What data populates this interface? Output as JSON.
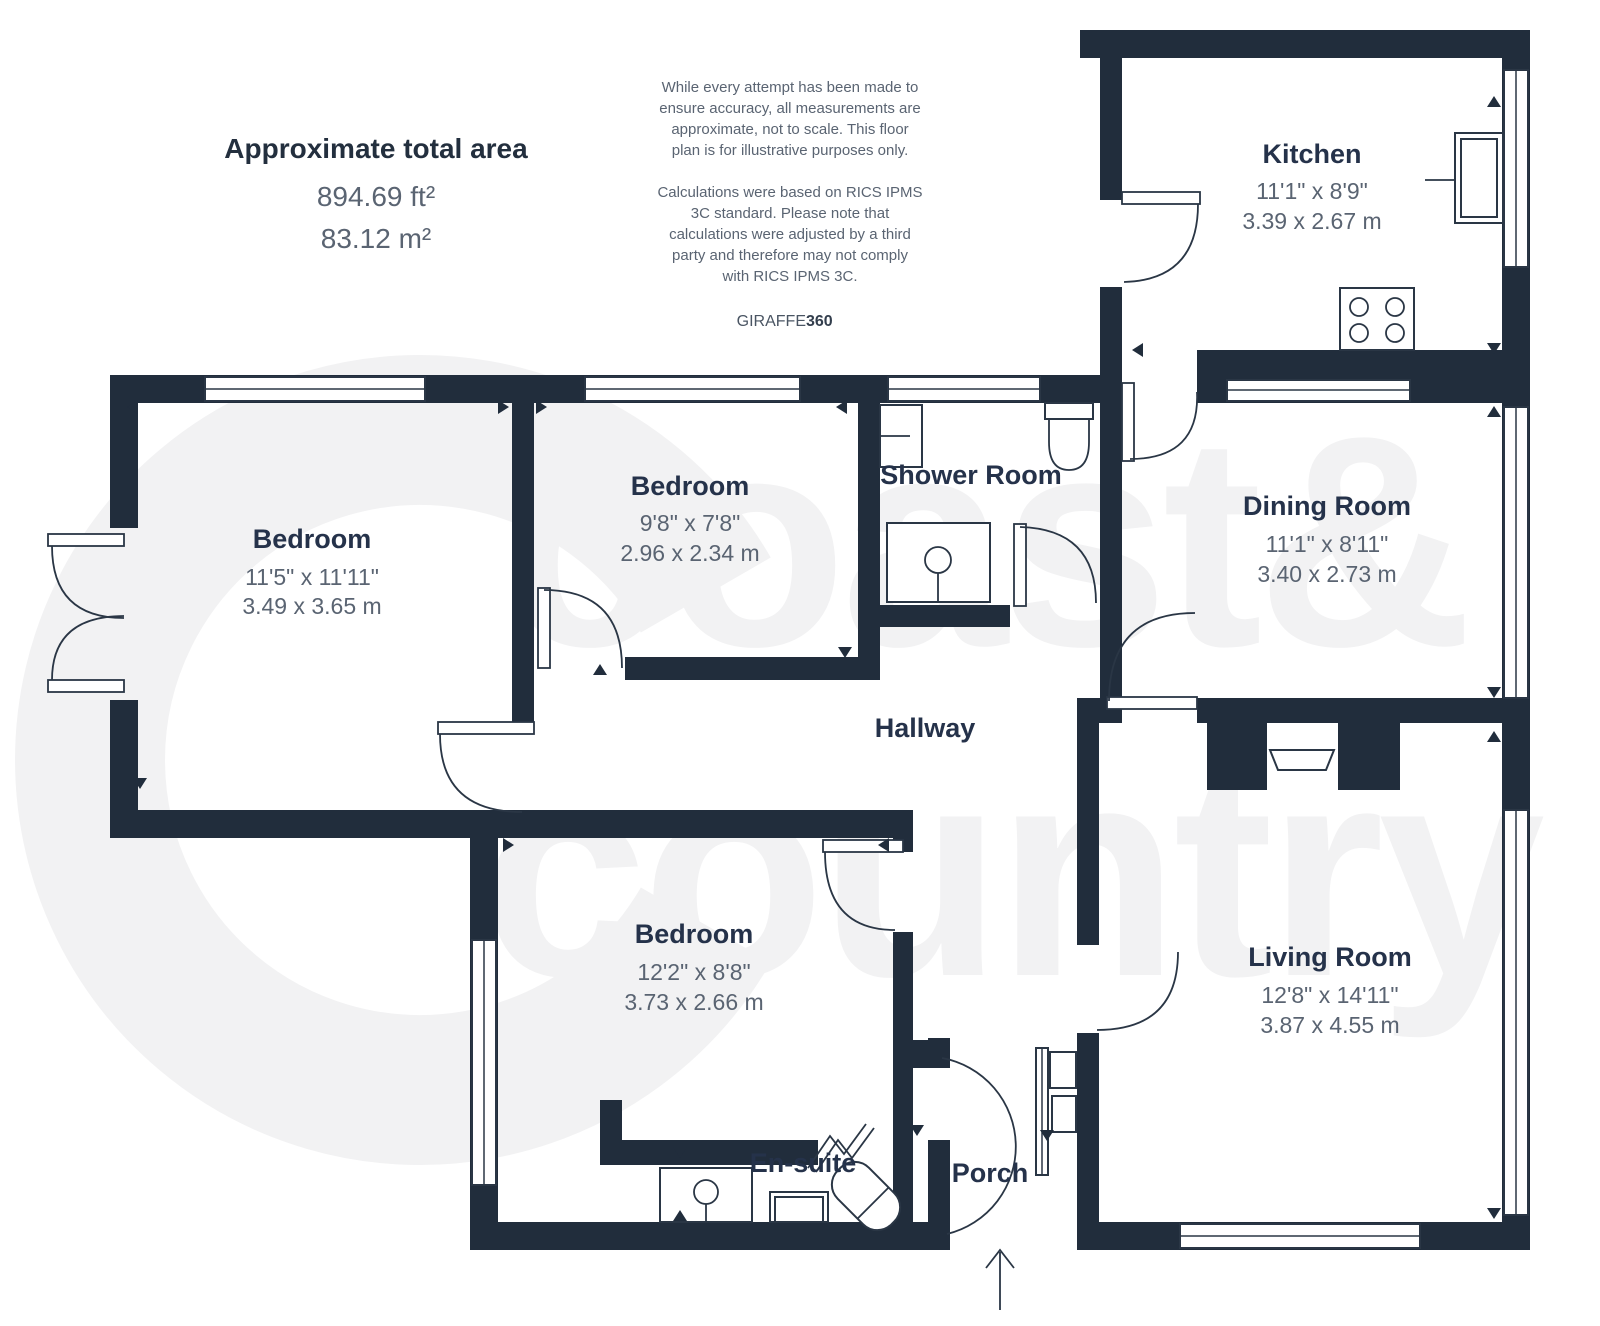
{
  "summary": {
    "title": "Approximate total area",
    "area_imperial": "894.69 ft²",
    "area_metric": "83.12 m²"
  },
  "disclaimer": {
    "para1": [
      "While every attempt has been made to",
      "ensure accuracy, all measurements are",
      "approximate, not to scale. This floor",
      "plan is for illustrative purposes only."
    ],
    "para2": [
      "Calculations were based on RICS IPMS",
      "3C standard. Please note that",
      "calculations were adjusted by a third",
      "party and therefore may not comply",
      "with RICS IPMS 3C."
    ]
  },
  "brand": {
    "name": "GIRAFFE",
    "suffix": "360"
  },
  "watermark": {
    "line1": "coast&",
    "line2": "country"
  },
  "rooms": {
    "kitchen": {
      "name": "Kitchen",
      "imperial": "11'1\" x 8'9\"",
      "metric": "3.39 x 2.67 m"
    },
    "dining": {
      "name": "Dining Room",
      "imperial": "11'1\" x 8'11\"",
      "metric": "3.40 x 2.73 m"
    },
    "bedroom1": {
      "name": "Bedroom",
      "imperial": "11'5\" x 11'11\"",
      "metric": "3.49 x 3.65 m"
    },
    "bedroom2": {
      "name": "Bedroom",
      "imperial": "9'8\" x 7'8\"",
      "metric": "2.96 x 2.34 m"
    },
    "bedroom3": {
      "name": "Bedroom",
      "imperial": "12'2\" x 8'8\"",
      "metric": "3.73 x 2.66 m"
    },
    "living": {
      "name": "Living Room",
      "imperial": "12'8\" x 14'11\"",
      "metric": "3.87 x 4.55 m"
    },
    "shower": {
      "name": "Shower Room"
    },
    "hallway": {
      "name": "Hallway"
    },
    "ensuite": {
      "name": "En-suite"
    },
    "porch": {
      "name": "Porch"
    }
  },
  "colors": {
    "wall": "#212D3C",
    "room_name_text": "#25324A",
    "dimension_text": "#5A6472",
    "watermark": "#F2F2F3",
    "background": "#FFFFFF"
  }
}
